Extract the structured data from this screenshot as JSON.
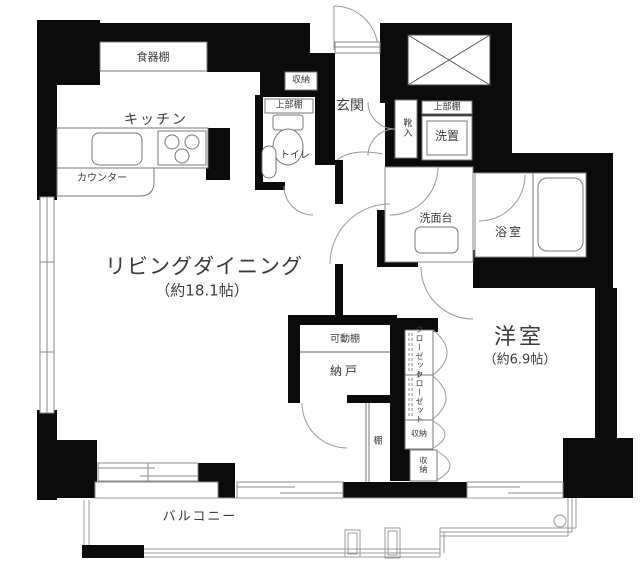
{
  "floorplan": {
    "type": "apartment-floor-plan",
    "rooms": {
      "living": {
        "name": "リビングダイニング",
        "size": "（約18.1帖）"
      },
      "western_room": {
        "name": "洋室",
        "size": "（約6.9帖）"
      },
      "kitchen": {
        "name": "キッチン"
      },
      "entrance": {
        "name": "玄関"
      },
      "toilet": {
        "name": "トイレ"
      },
      "washroom": {
        "name": "洗面台"
      },
      "bathroom": {
        "name": "浴室"
      },
      "storage_room": {
        "name": "納戸"
      },
      "balcony": {
        "name": "バルコニー"
      }
    },
    "fixtures": {
      "dish_shelf": "食器棚",
      "counter": "カウンター",
      "hall_storage": "収納",
      "toilet_upper_shelf": "上部棚",
      "shoe_cabinet": "靴入",
      "washer_upper_shelf": "上部棚",
      "washer_place": "洗置",
      "movable_shelf": "可動棚",
      "closet_1": "クローゼット",
      "closet_2": "クローゼット",
      "storage_1": "収納",
      "storage_2": "収納",
      "shelf": "棚"
    },
    "colors": {
      "wall": "#0b0b0b",
      "line": "#999999",
      "fixture_line": "#777777",
      "text": "#3b3b3b",
      "background": "#ffffff"
    }
  }
}
